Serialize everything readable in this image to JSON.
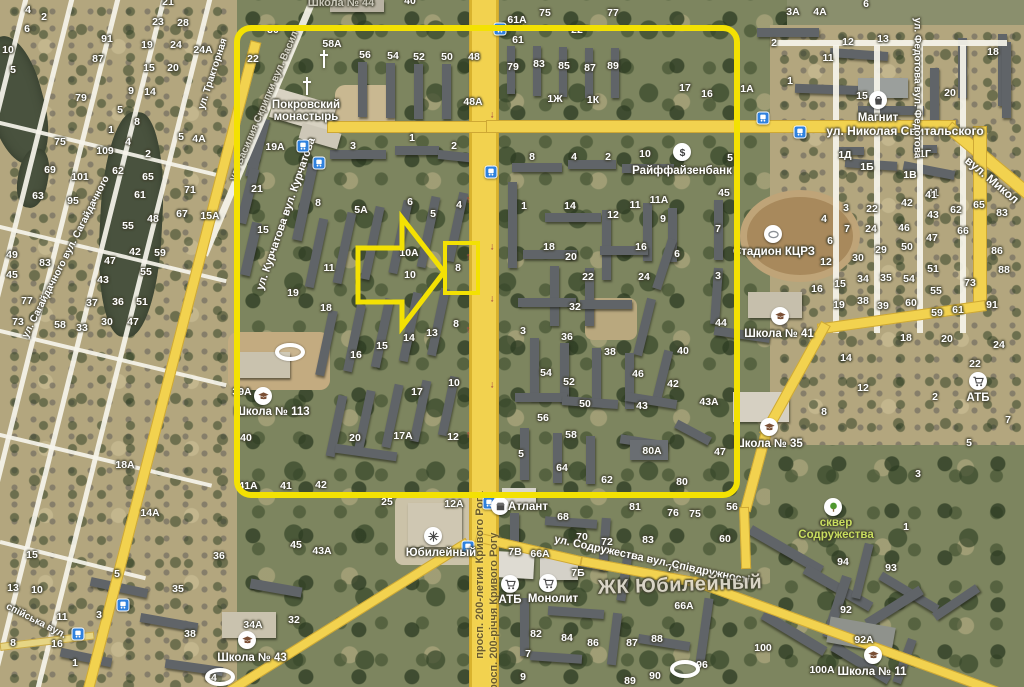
{
  "map": {
    "width": 1024,
    "height": 687
  },
  "annotation": {
    "color": "#f3e103",
    "rect": {
      "x": 237,
      "y": 28,
      "w": 500,
      "h": 467,
      "rx": 14,
      "stroke": 6
    },
    "target_box": {
      "x": 445,
      "y": 243,
      "w": 33,
      "h": 50,
      "stroke": 4
    },
    "arrow_points": "358,248 402,248 402,218 444,272 402,327 402,302 358,302",
    "arrow_stroke": 5
  },
  "streets": [
    {
      "t": "ул. Николая Свитальского",
      "x": 905,
      "y": 131,
      "r": 0,
      "s": 12
    },
    {
      "t": "вул. Микол",
      "x": 992,
      "y": 180,
      "r": 40,
      "s": 12
    },
    {
      "t": "ул. Курчатова вул. Курчатова",
      "x": 286,
      "y": 214,
      "r": -71,
      "s": 11
    },
    {
      "t": "ул. Василия Скрипки вул. Васил",
      "x": 264,
      "y": 106,
      "r": -67,
      "s": 10,
      "dim": 1
    },
    {
      "t": "ул. Сагайдачного вул. Сагайдачного",
      "x": 66,
      "y": 257,
      "r": -63,
      "s": 10
    },
    {
      "t": "ул. Тракторная",
      "x": 213,
      "y": 74,
      "r": -72,
      "s": 10
    },
    {
      "t": "ул. Федотова вул. Федотова",
      "x": 917,
      "y": 88,
      "r": 90,
      "s": 10
    },
    {
      "t": "просп. 200-летия Кривого Рога",
      "x": 480,
      "y": 575,
      "r": -90,
      "s": 11,
      "dark": 1
    },
    {
      "t": "просп. 200-річчя Кривого Рогу",
      "x": 494,
      "y": 615,
      "r": -90,
      "s": 11,
      "dark": 1
    },
    {
      "t": "ул. Содружества вул. Співдружності",
      "x": 652,
      "y": 560,
      "r": 12,
      "s": 11
    },
    {
      "t": "спійська вул.",
      "x": 36,
      "y": 621,
      "r": 27,
      "s": 10
    }
  ],
  "pois": [
    {
      "icon": "cross-icon",
      "x": 324,
      "y": 59
    },
    {
      "icon": "cross-icon",
      "x": 307,
      "y": 86
    },
    {
      "label": "Покровский\nмонастырь",
      "x": 306,
      "y": 111
    },
    {
      "icon": "dollar-icon",
      "x": 682,
      "y": 152,
      "label": "Райффайзенбанк",
      "lx": 682,
      "ly": 171
    },
    {
      "icon": "bag-icon",
      "x": 878,
      "y": 100,
      "label": "Магнит",
      "lx": 878,
      "ly": 118
    },
    {
      "icon": "stadium-icon",
      "x": 773,
      "y": 234,
      "label": "Стадион КЦРЗ",
      "lx": 774,
      "ly": 252
    },
    {
      "icon": "school-icon",
      "x": 780,
      "y": 316,
      "label": "Школа № 41",
      "lx": 779,
      "ly": 334
    },
    {
      "icon": "school-icon",
      "x": 263,
      "y": 396,
      "label": "Школа № 113",
      "lx": 272,
      "ly": 412
    },
    {
      "icon": "school-icon",
      "x": 769,
      "y": 427,
      "label": "Школа № 35",
      "lx": 768,
      "ly": 444
    },
    {
      "icon": "school-icon",
      "x": 247,
      "y": 640,
      "label": "Школа № 43",
      "lx": 252,
      "ly": 658
    },
    {
      "icon": "school-icon",
      "x": 873,
      "y": 655,
      "label": "Школа № 11",
      "lx": 872,
      "ly": 672
    },
    {
      "label": "Школа № 44",
      "x": 341,
      "y": 3,
      "style": "dim"
    },
    {
      "icon": "cart-icon",
      "x": 510,
      "y": 584,
      "label": "АТБ",
      "lx": 510,
      "ly": 600
    },
    {
      "icon": "cart-icon",
      "x": 548,
      "y": 583,
      "label": "Монолит",
      "lx": 553,
      "ly": 599
    },
    {
      "icon": "cart-icon",
      "x": 978,
      "y": 381,
      "label": "АТБ",
      "lx": 978,
      "ly": 398
    },
    {
      "icon": "store-icon",
      "x": 500,
      "y": 506,
      "label": "Атлант",
      "lx": 528,
      "ly": 507
    },
    {
      "icon": "attraction-icon",
      "x": 433,
      "y": 536,
      "label": "Юбилейный",
      "lx": 441,
      "ly": 553
    },
    {
      "icon": "tree-icon",
      "x": 833,
      "y": 507,
      "label": "сквер\nСодружества",
      "lx": 836,
      "ly": 529,
      "style": "green"
    },
    {
      "label": "ЖК Юбилейный",
      "x": 680,
      "y": 585,
      "style": "big"
    },
    {
      "icon": "stadium-oval-icon",
      "x": 290,
      "y": 352
    },
    {
      "icon": "stadium-oval-icon",
      "x": 685,
      "y": 669
    },
    {
      "icon": "stadium-oval-icon",
      "x": 220,
      "y": 677
    }
  ],
  "house_numbers": [
    [
      28,
      10,
      "4"
    ],
    [
      44,
      17,
      "2"
    ],
    [
      27,
      29,
      "6"
    ],
    [
      8,
      50,
      "10"
    ],
    [
      13,
      70,
      "5"
    ],
    [
      107,
      39,
      "91"
    ],
    [
      98,
      59,
      "87"
    ],
    [
      81,
      98,
      "79"
    ],
    [
      131,
      91,
      "9"
    ],
    [
      150,
      92,
      "14"
    ],
    [
      149,
      68,
      "15"
    ],
    [
      173,
      68,
      "20"
    ],
    [
      147,
      45,
      "19"
    ],
    [
      176,
      45,
      "24"
    ],
    [
      203,
      50,
      "24А"
    ],
    [
      158,
      22,
      "23"
    ],
    [
      183,
      23,
      "28"
    ],
    [
      168,
      2,
      "21"
    ],
    [
      60,
      142,
      "75"
    ],
    [
      105,
      151,
      "109"
    ],
    [
      50,
      170,
      "69"
    ],
    [
      80,
      177,
      "101"
    ],
    [
      38,
      196,
      "63"
    ],
    [
      73,
      201,
      "95"
    ],
    [
      118,
      171,
      "62"
    ],
    [
      148,
      177,
      "65"
    ],
    [
      140,
      195,
      "61"
    ],
    [
      128,
      226,
      "55"
    ],
    [
      153,
      219,
      "48"
    ],
    [
      12,
      255,
      "49"
    ],
    [
      45,
      263,
      "83"
    ],
    [
      12,
      275,
      "45"
    ],
    [
      135,
      252,
      "42"
    ],
    [
      160,
      253,
      "59"
    ],
    [
      110,
      261,
      "47"
    ],
    [
      103,
      280,
      "43"
    ],
    [
      146,
      272,
      "55"
    ],
    [
      27,
      301,
      "77"
    ],
    [
      18,
      322,
      "73"
    ],
    [
      60,
      325,
      "58"
    ],
    [
      92,
      303,
      "37"
    ],
    [
      118,
      302,
      "36"
    ],
    [
      142,
      302,
      "51"
    ],
    [
      107,
      322,
      "30"
    ],
    [
      82,
      328,
      "33"
    ],
    [
      120,
      110,
      "5"
    ],
    [
      137,
      122,
      "8"
    ],
    [
      111,
      130,
      "1"
    ],
    [
      128,
      142,
      "4"
    ],
    [
      148,
      154,
      "2"
    ],
    [
      181,
      137,
      "5"
    ],
    [
      199,
      139,
      "4А"
    ],
    [
      190,
      190,
      "71"
    ],
    [
      182,
      214,
      "67"
    ],
    [
      210,
      216,
      "15А"
    ],
    [
      133,
      322,
      "47"
    ],
    [
      32,
      555,
      "15"
    ],
    [
      13,
      588,
      "13"
    ],
    [
      37,
      590,
      "10"
    ],
    [
      62,
      617,
      "11"
    ],
    [
      13,
      643,
      "8"
    ],
    [
      57,
      644,
      "16"
    ],
    [
      75,
      663,
      "1"
    ],
    [
      99,
      615,
      "3"
    ],
    [
      117,
      574,
      "5"
    ],
    [
      219,
      556,
      "36"
    ],
    [
      178,
      589,
      "35"
    ],
    [
      190,
      634,
      "38"
    ],
    [
      253,
      625,
      "34А"
    ],
    [
      294,
      620,
      "32"
    ],
    [
      211,
      678,
      "34"
    ],
    [
      125,
      465,
      "18А"
    ],
    [
      150,
      513,
      "14А"
    ],
    [
      296,
      545,
      "45"
    ],
    [
      322,
      551,
      "43А"
    ],
    [
      273,
      30,
      "30"
    ],
    [
      253,
      59,
      "22"
    ],
    [
      332,
      44,
      "58А"
    ],
    [
      365,
      55,
      "56"
    ],
    [
      393,
      56,
      "54"
    ],
    [
      419,
      57,
      "52"
    ],
    [
      447,
      57,
      "50"
    ],
    [
      474,
      57,
      "48"
    ],
    [
      275,
      147,
      "19А"
    ],
    [
      353,
      146,
      "3"
    ],
    [
      412,
      138,
      "1"
    ],
    [
      454,
      146,
      "2"
    ],
    [
      257,
      189,
      "21"
    ],
    [
      263,
      230,
      "15"
    ],
    [
      318,
      203,
      "8"
    ],
    [
      361,
      210,
      "5А"
    ],
    [
      410,
      202,
      "6"
    ],
    [
      433,
      214,
      "5"
    ],
    [
      459,
      205,
      "4"
    ],
    [
      329,
      268,
      "11"
    ],
    [
      293,
      293,
      "19"
    ],
    [
      326,
      308,
      "18"
    ],
    [
      409,
      253,
      "10А"
    ],
    [
      410,
      275,
      "10"
    ],
    [
      458,
      268,
      "8"
    ],
    [
      456,
      324,
      "8"
    ],
    [
      382,
      346,
      "15"
    ],
    [
      432,
      333,
      "13"
    ],
    [
      409,
      338,
      "14"
    ],
    [
      356,
      355,
      "16"
    ],
    [
      417,
      392,
      "17"
    ],
    [
      454,
      383,
      "10"
    ],
    [
      242,
      392,
      "39А"
    ],
    [
      246,
      438,
      "40"
    ],
    [
      355,
      438,
      "20"
    ],
    [
      403,
      436,
      "17А"
    ],
    [
      453,
      437,
      "12"
    ],
    [
      248,
      486,
      "41А"
    ],
    [
      286,
      486,
      "41"
    ],
    [
      321,
      485,
      "42"
    ],
    [
      387,
      502,
      "25"
    ],
    [
      454,
      504,
      "12А"
    ],
    [
      410,
      1,
      "40"
    ],
    [
      545,
      13,
      "75"
    ],
    [
      613,
      13,
      "77"
    ],
    [
      517,
      20,
      "61А"
    ],
    [
      577,
      30,
      "22"
    ],
    [
      518,
      40,
      "61"
    ],
    [
      513,
      67,
      "79"
    ],
    [
      539,
      64,
      "83"
    ],
    [
      564,
      66,
      "85"
    ],
    [
      590,
      68,
      "87"
    ],
    [
      613,
      66,
      "89"
    ],
    [
      555,
      99,
      "1Ж"
    ],
    [
      593,
      100,
      "1К"
    ],
    [
      473,
      102,
      "48А"
    ],
    [
      532,
      157,
      "8"
    ],
    [
      574,
      157,
      "4"
    ],
    [
      608,
      157,
      "2"
    ],
    [
      645,
      154,
      "10"
    ],
    [
      730,
      158,
      "5"
    ],
    [
      524,
      206,
      "1"
    ],
    [
      570,
      206,
      "14"
    ],
    [
      613,
      215,
      "12"
    ],
    [
      635,
      205,
      "11"
    ],
    [
      659,
      200,
      "11А"
    ],
    [
      663,
      219,
      "9"
    ],
    [
      724,
      193,
      "45"
    ],
    [
      718,
      229,
      "7"
    ],
    [
      549,
      247,
      "18"
    ],
    [
      641,
      247,
      "16"
    ],
    [
      677,
      254,
      "6"
    ],
    [
      571,
      257,
      "20"
    ],
    [
      588,
      277,
      "22"
    ],
    [
      644,
      277,
      "24"
    ],
    [
      718,
      276,
      "3"
    ],
    [
      575,
      307,
      "32"
    ],
    [
      523,
      331,
      "3"
    ],
    [
      567,
      337,
      "36"
    ],
    [
      610,
      352,
      "38"
    ],
    [
      721,
      323,
      "44"
    ],
    [
      683,
      351,
      "40"
    ],
    [
      638,
      374,
      "46"
    ],
    [
      673,
      384,
      "42"
    ],
    [
      709,
      402,
      "43А"
    ],
    [
      546,
      373,
      "54"
    ],
    [
      569,
      382,
      "52"
    ],
    [
      585,
      404,
      "50"
    ],
    [
      642,
      406,
      "43"
    ],
    [
      543,
      418,
      "56"
    ],
    [
      571,
      435,
      "58"
    ],
    [
      521,
      454,
      "5"
    ],
    [
      562,
      468,
      "64"
    ],
    [
      607,
      480,
      "62"
    ],
    [
      652,
      451,
      "80А"
    ],
    [
      720,
      452,
      "47"
    ],
    [
      682,
      482,
      "80"
    ],
    [
      793,
      12,
      "3А"
    ],
    [
      820,
      12,
      "4А"
    ],
    [
      866,
      4,
      "6"
    ],
    [
      774,
      43,
      "2"
    ],
    [
      848,
      42,
      "12"
    ],
    [
      883,
      39,
      "13"
    ],
    [
      828,
      58,
      "11"
    ],
    [
      790,
      81,
      "1"
    ],
    [
      862,
      96,
      "15"
    ],
    [
      685,
      88,
      "17"
    ],
    [
      707,
      94,
      "16"
    ],
    [
      747,
      89,
      "1А"
    ],
    [
      993,
      52,
      "18"
    ],
    [
      950,
      93,
      "20"
    ],
    [
      845,
      155,
      "1Д"
    ],
    [
      925,
      154,
      "1Г"
    ],
    [
      867,
      167,
      "1Б"
    ],
    [
      910,
      175,
      "1В"
    ],
    [
      933,
      193,
      "41"
    ],
    [
      846,
      208,
      "3"
    ],
    [
      824,
      219,
      "4"
    ],
    [
      847,
      229,
      "7"
    ],
    [
      830,
      241,
      "6"
    ],
    [
      826,
      262,
      "12"
    ],
    [
      817,
      289,
      "16"
    ],
    [
      840,
      284,
      "15"
    ],
    [
      839,
      305,
      "19"
    ],
    [
      872,
      209,
      "22"
    ],
    [
      871,
      229,
      "24"
    ],
    [
      881,
      250,
      "29"
    ],
    [
      858,
      258,
      "30"
    ],
    [
      863,
      279,
      "34"
    ],
    [
      863,
      301,
      "38"
    ],
    [
      886,
      278,
      "35"
    ],
    [
      883,
      306,
      "39"
    ],
    [
      907,
      203,
      "42"
    ],
    [
      931,
      195,
      "41"
    ],
    [
      933,
      215,
      "43"
    ],
    [
      904,
      228,
      "46"
    ],
    [
      932,
      238,
      "47"
    ],
    [
      907,
      247,
      "50"
    ],
    [
      933,
      269,
      "51"
    ],
    [
      909,
      279,
      "54"
    ],
    [
      936,
      291,
      "55"
    ],
    [
      911,
      303,
      "60"
    ],
    [
      937,
      313,
      "59"
    ],
    [
      956,
      210,
      "62"
    ],
    [
      979,
      205,
      "65"
    ],
    [
      963,
      231,
      "66"
    ],
    [
      970,
      283,
      "73"
    ],
    [
      958,
      310,
      "61"
    ],
    [
      1002,
      213,
      "83"
    ],
    [
      997,
      251,
      "86"
    ],
    [
      1004,
      270,
      "88"
    ],
    [
      992,
      305,
      "91"
    ],
    [
      846,
      358,
      "14"
    ],
    [
      906,
      338,
      "18"
    ],
    [
      947,
      339,
      "20"
    ],
    [
      999,
      345,
      "24"
    ],
    [
      975,
      364,
      "22"
    ],
    [
      935,
      397,
      "2"
    ],
    [
      1008,
      420,
      "7"
    ],
    [
      969,
      443,
      "5"
    ],
    [
      863,
      388,
      "12"
    ],
    [
      824,
      412,
      "8"
    ],
    [
      918,
      474,
      "3"
    ],
    [
      906,
      527,
      "1"
    ],
    [
      732,
      507,
      "56"
    ],
    [
      725,
      539,
      "60"
    ],
    [
      563,
      517,
      "68"
    ],
    [
      582,
      537,
      "70"
    ],
    [
      607,
      542,
      "72"
    ],
    [
      635,
      507,
      "81"
    ],
    [
      673,
      513,
      "76"
    ],
    [
      695,
      514,
      "75"
    ],
    [
      648,
      540,
      "83"
    ],
    [
      673,
      568,
      "74"
    ],
    [
      578,
      573,
      "7Б"
    ],
    [
      515,
      552,
      "7В"
    ],
    [
      540,
      554,
      "66А"
    ],
    [
      536,
      634,
      "82"
    ],
    [
      567,
      638,
      "84"
    ],
    [
      593,
      643,
      "86"
    ],
    [
      632,
      643,
      "87"
    ],
    [
      657,
      639,
      "88"
    ],
    [
      528,
      654,
      "7"
    ],
    [
      523,
      677,
      "9"
    ],
    [
      630,
      681,
      "89"
    ],
    [
      655,
      676,
      "90"
    ],
    [
      684,
      606,
      "66А"
    ],
    [
      843,
      562,
      "94"
    ],
    [
      891,
      568,
      "93"
    ],
    [
      846,
      610,
      "92"
    ],
    [
      864,
      640,
      "92А"
    ],
    [
      763,
      648,
      "100"
    ],
    [
      822,
      670,
      "100А"
    ],
    [
      702,
      665,
      "96"
    ]
  ],
  "bus_stops": [
    [
      303,
      146
    ],
    [
      319,
      163
    ],
    [
      500,
      29
    ],
    [
      491,
      172
    ],
    [
      763,
      118
    ],
    [
      800,
      132
    ],
    [
      489,
      503
    ],
    [
      468,
      547
    ],
    [
      123,
      605
    ],
    [
      78,
      634
    ]
  ],
  "road_arrows": [
    [
      492,
      115,
      "↓"
    ],
    [
      492,
      168,
      "↓"
    ],
    [
      492,
      247,
      "↓"
    ],
    [
      492,
      299,
      "↓"
    ],
    [
      492,
      385,
      "↓"
    ],
    [
      468,
      200,
      "↑"
    ],
    [
      468,
      257,
      "↑"
    ],
    [
      468,
      330,
      "↑"
    ],
    [
      468,
      435,
      "↑"
    ]
  ]
}
